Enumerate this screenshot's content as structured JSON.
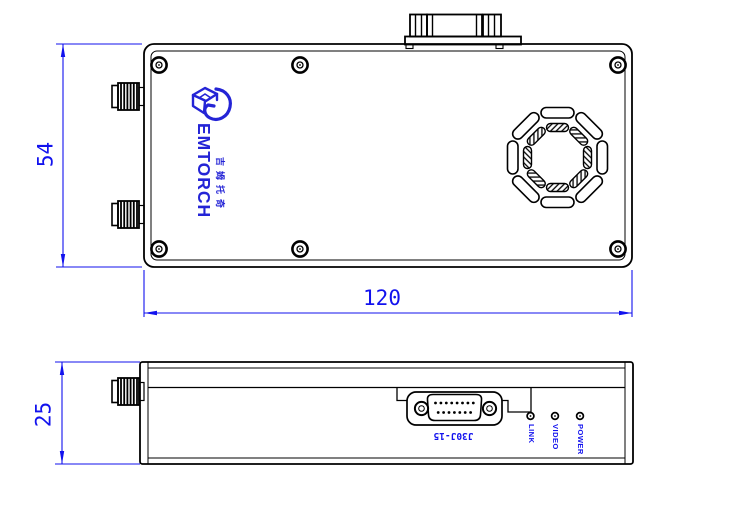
{
  "drawing": {
    "colors": {
      "line": "#000000",
      "annotation": "#1212ee",
      "logo": "#2424d6"
    },
    "top_view": {
      "dim_height_label": "54",
      "dim_width_label": "120",
      "logo": {
        "brand": "GEMTORCH",
        "wordmark": "EMTORCH",
        "cjk_text": "吉姆托奇"
      }
    },
    "side_view": {
      "dim_height_label": "25",
      "connector_label": "J30J-15",
      "led_labels": [
        "LINK",
        "VIDEO",
        "POWER"
      ],
      "dsub_pins_top": 8,
      "dsub_pins_bottom": 7
    }
  }
}
